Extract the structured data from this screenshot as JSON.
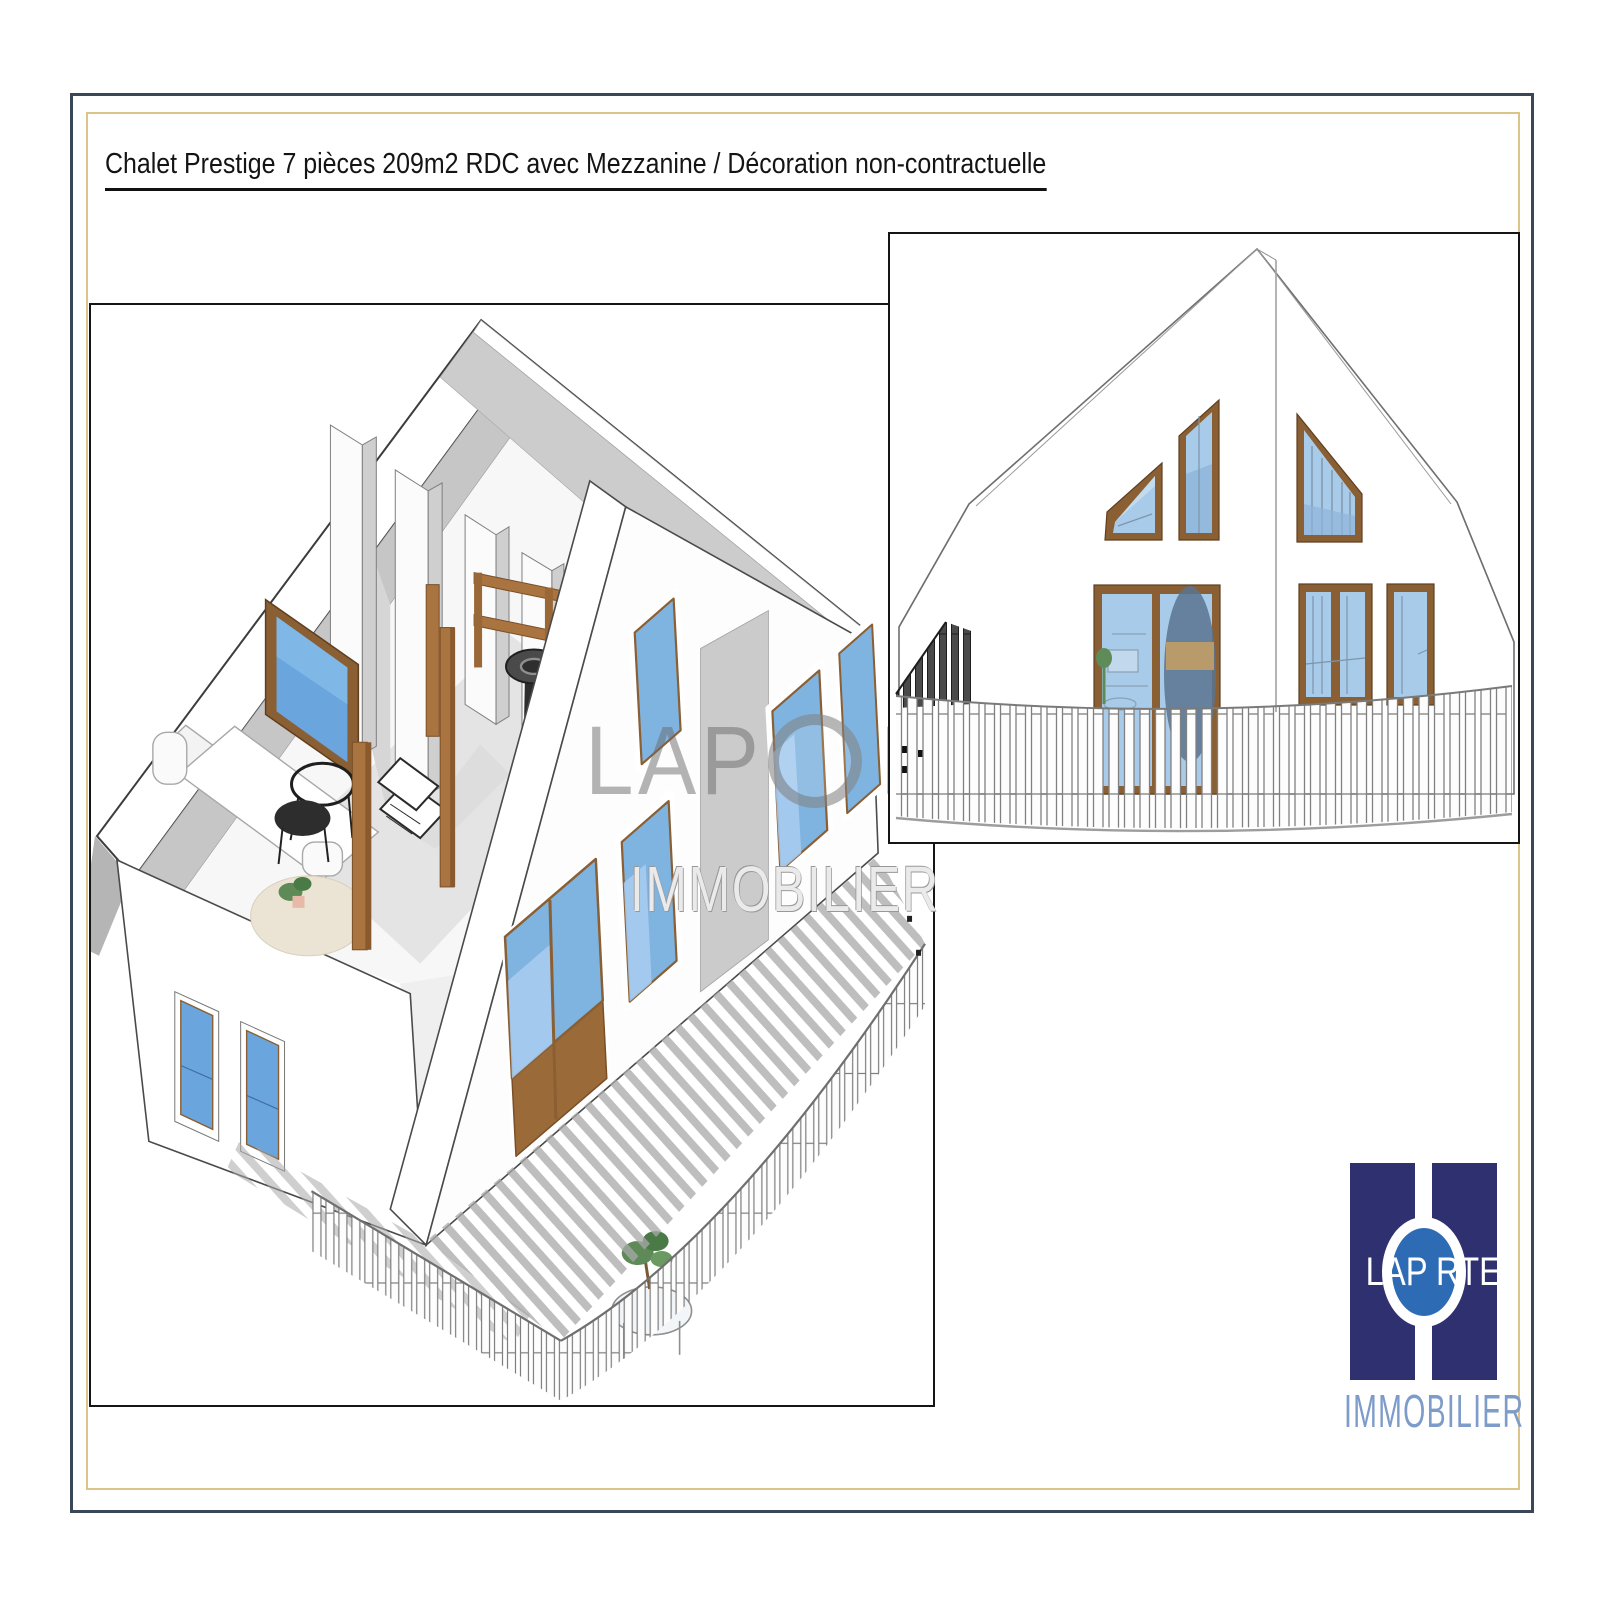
{
  "page": {
    "title": "Chalet Prestige 7 pièces 209m2 RDC avec Mezzanine / Décoration non-contractuelle"
  },
  "watermark": {
    "brand_left": "LAP",
    "brand_right": "RTE",
    "subtitle": "IMMOBILIER"
  },
  "logo": {
    "brand_left": "LAP",
    "brand_right": "RTE",
    "subtitle": "IMMOBILIER"
  },
  "colors": {
    "frame_outer": "#3A4759",
    "frame_inner": "#DCC488",
    "panel_border": "#151515",
    "logo_navy": "#2F3070",
    "logo_circle_blue": "#2D6CB5",
    "logo_subtitle_blue": "#7E9CC9",
    "window_glass_blue": "#7FB3E0",
    "window_glass_light": "#A9CDF0",
    "wood_brown": "#A9743F",
    "window_frame_brown": "#8A5F33",
    "shadow_gray": "#A8A8A8"
  }
}
